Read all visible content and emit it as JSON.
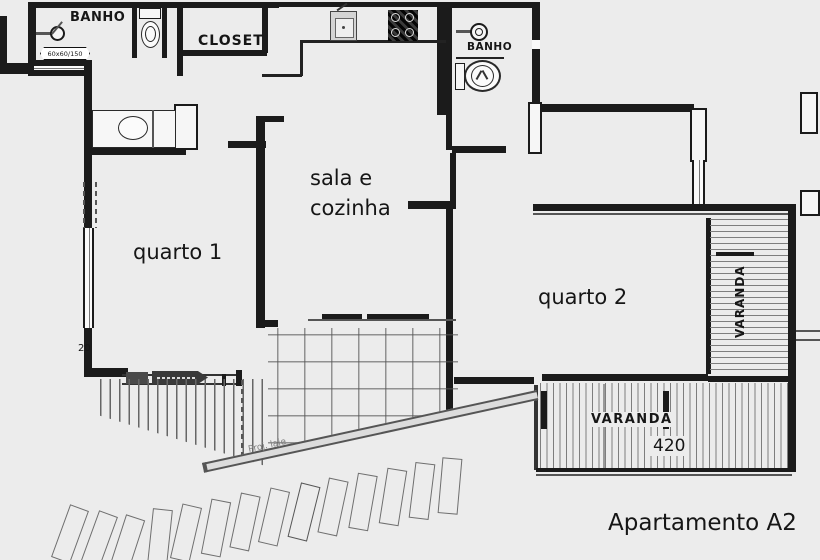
{
  "title": "Apartamento A2",
  "rooms": {
    "banho_suite": {
      "label": "BANHO"
    },
    "closet": {
      "label": "CLOSET"
    },
    "banho_social": {
      "label": "BANHO"
    },
    "sala_cozinha": {
      "line1": "sala e",
      "line2": "cozinha"
    },
    "quarto1": {
      "label": "quarto 1"
    },
    "quarto2": {
      "label": "quarto 2"
    },
    "varanda_lateral": {
      "label": "VARANDA"
    },
    "varanda_frontal": {
      "label": "VARANDA",
      "dimension": "420"
    }
  },
  "annotations": {
    "window_tag": "60x60/150",
    "wall_dim": "20",
    "projection": "Proj. laje"
  },
  "colors": {
    "background": "#ececec",
    "walls": "#1b1b1b",
    "hatch": "#7e7e7e",
    "text": "#161616"
  }
}
